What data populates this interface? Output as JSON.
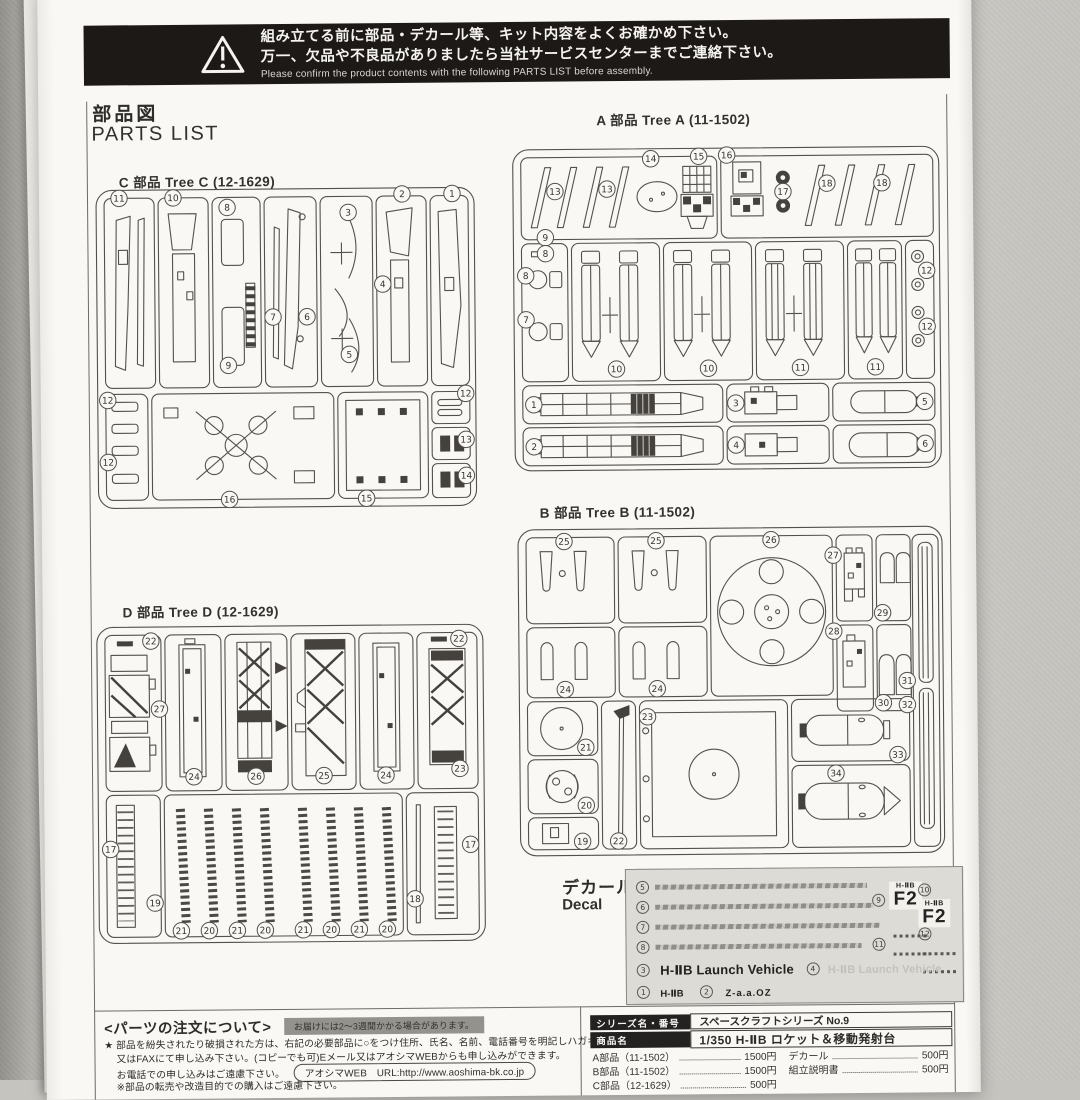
{
  "banner": {
    "line1": "組み立てる前に部品・デカール等、キット内容をよくお確かめ下さい。",
    "line2": "万一、欠品や不良品がありましたら当社サービスセンターまでご連絡下さい。",
    "line_en": "Please confirm the product contents with the following PARTS LIST before assembly."
  },
  "page_title": {
    "jp": "部品図",
    "en": "PARTS LIST"
  },
  "trees": {
    "c": {
      "title": "C 部品 Tree C (12-1629)",
      "badges": [
        "11",
        "10",
        "8",
        "2",
        "1",
        "3",
        "4",
        "5",
        "6",
        "7",
        "9",
        "12",
        "12",
        "16",
        "15",
        "12",
        "13",
        "14"
      ]
    },
    "a": {
      "title": "A 部品 Tree A (11-1502)",
      "badges": [
        "13",
        "13",
        "14",
        "15",
        "16",
        "17",
        "18",
        "18",
        "9",
        "8",
        "8",
        "7",
        "10",
        "10",
        "11",
        "11",
        "12",
        "12",
        "1",
        "3",
        "5",
        "2",
        "4",
        "6"
      ]
    },
    "b": {
      "title": "B 部品 Tree B (11-1502)",
      "badges": [
        "25",
        "25",
        "26",
        "27",
        "29",
        "24",
        "24",
        "28",
        "30",
        "21",
        "20",
        "19",
        "22",
        "23",
        "33",
        "34",
        "31",
        "32"
      ]
    },
    "d": {
      "title": "D 部品 Tree D (12-1629)",
      "badges": [
        "22",
        "27",
        "24",
        "26",
        "25",
        "24",
        "23",
        "22",
        "17",
        "19",
        "21",
        "20",
        "21",
        "20",
        "21",
        "20",
        "21",
        "20",
        "18",
        "17"
      ]
    }
  },
  "decal": {
    "label_jp": "デカール",
    "label_en": "Decal",
    "numbers": {
      "stripe1": "5",
      "stripe2": "6",
      "stripe3": "7",
      "stripe4": "8",
      "f2a": "9",
      "f2b": "10",
      "dash1": "11",
      "dash2": "12",
      "lv": "3",
      "lv_ghost": "4",
      "hiib": "1",
      "logo": "2"
    },
    "f2_small": "H-ⅡB",
    "f2_big": "F2",
    "launch_vehicle": "H-ⅡB Launch Vehicle",
    "launch_vehicle_ghost": "H-ⅡB Launch Vehicle",
    "hiib": "H-ⅡB",
    "logo_text": "Z-a.a.OZ"
  },
  "order": {
    "heading": "<パーツの注文について>",
    "note": "お届けには2〜3週間かかる場合があります。",
    "line1": "★ 部品を紛失されたり破損された方は、右記の必要部品に○をつけ住所、氏名、名前、電話番号を明記しハガキ",
    "line2": "又はFAXにて申し込み下さい。(コピーでも可)Eメール又はアオシマWEBからも申し込みができます。",
    "line3": "お電話での申し込みはご遠慮下さい。",
    "web": "アオシマWEB　URL:http://www.aoshima-bk.co.jp",
    "line4": "※部品の転売や改造目的での購入はご遠慮下さい。"
  },
  "info_table": {
    "series_label": "シリーズ名・番号",
    "series_value": "スペースクラフトシリーズ No.9",
    "product_label": "商品名",
    "product_value": "1/350 H-ⅡB ロケット＆移動発射台",
    "prices_left": [
      {
        "name": "A部品（11-1502）",
        "price": "1500円"
      },
      {
        "name": "B部品（11-1502）",
        "price": "1500円"
      },
      {
        "name": "C部品（12-1629）",
        "price": "500円"
      }
    ],
    "prices_right": [
      {
        "name": "デカール",
        "price": "500円"
      },
      {
        "name": "組立説明書",
        "price": "500円"
      }
    ]
  }
}
